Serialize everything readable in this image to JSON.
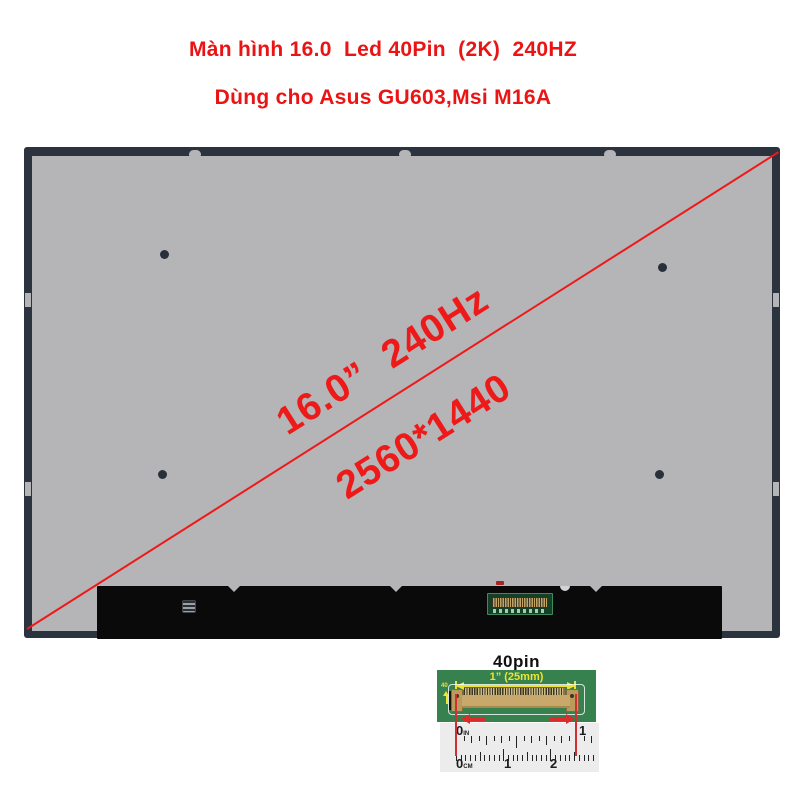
{
  "header": {
    "line1": "Màn hình 16.0  Led 40Pin  (2K)  240HZ",
    "line2": "Dùng cho Asus GU603,Msi M16A"
  },
  "panel": {
    "label_size_refresh": "16.0”  240Hz",
    "label_resolution": "2560*1440"
  },
  "connector_figure": {
    "title": "40pin",
    "dimension_label": "1” (25mm)",
    "pin_count_label": "40",
    "ruler": {
      "inch_zero": {
        "num": "0",
        "unit": "IN"
      },
      "inch_one": "1",
      "cm_zero": {
        "num": "0",
        "unit": "CM"
      },
      "cm_one": "1",
      "cm_two": "2"
    }
  },
  "colors": {
    "header_red": "#ea1414",
    "annotation_red": "#ee1a1a",
    "measure_red": "#dd2a2a",
    "panel_border": "#2b333e",
    "panel_gray": "#b5b4b6",
    "strip_black": "#0a0a0a",
    "pcb_green": "#37814f",
    "dimension_yellow": "#eee431",
    "connector_tan": "#c9a96b",
    "ruler_bg": "#ececed"
  }
}
